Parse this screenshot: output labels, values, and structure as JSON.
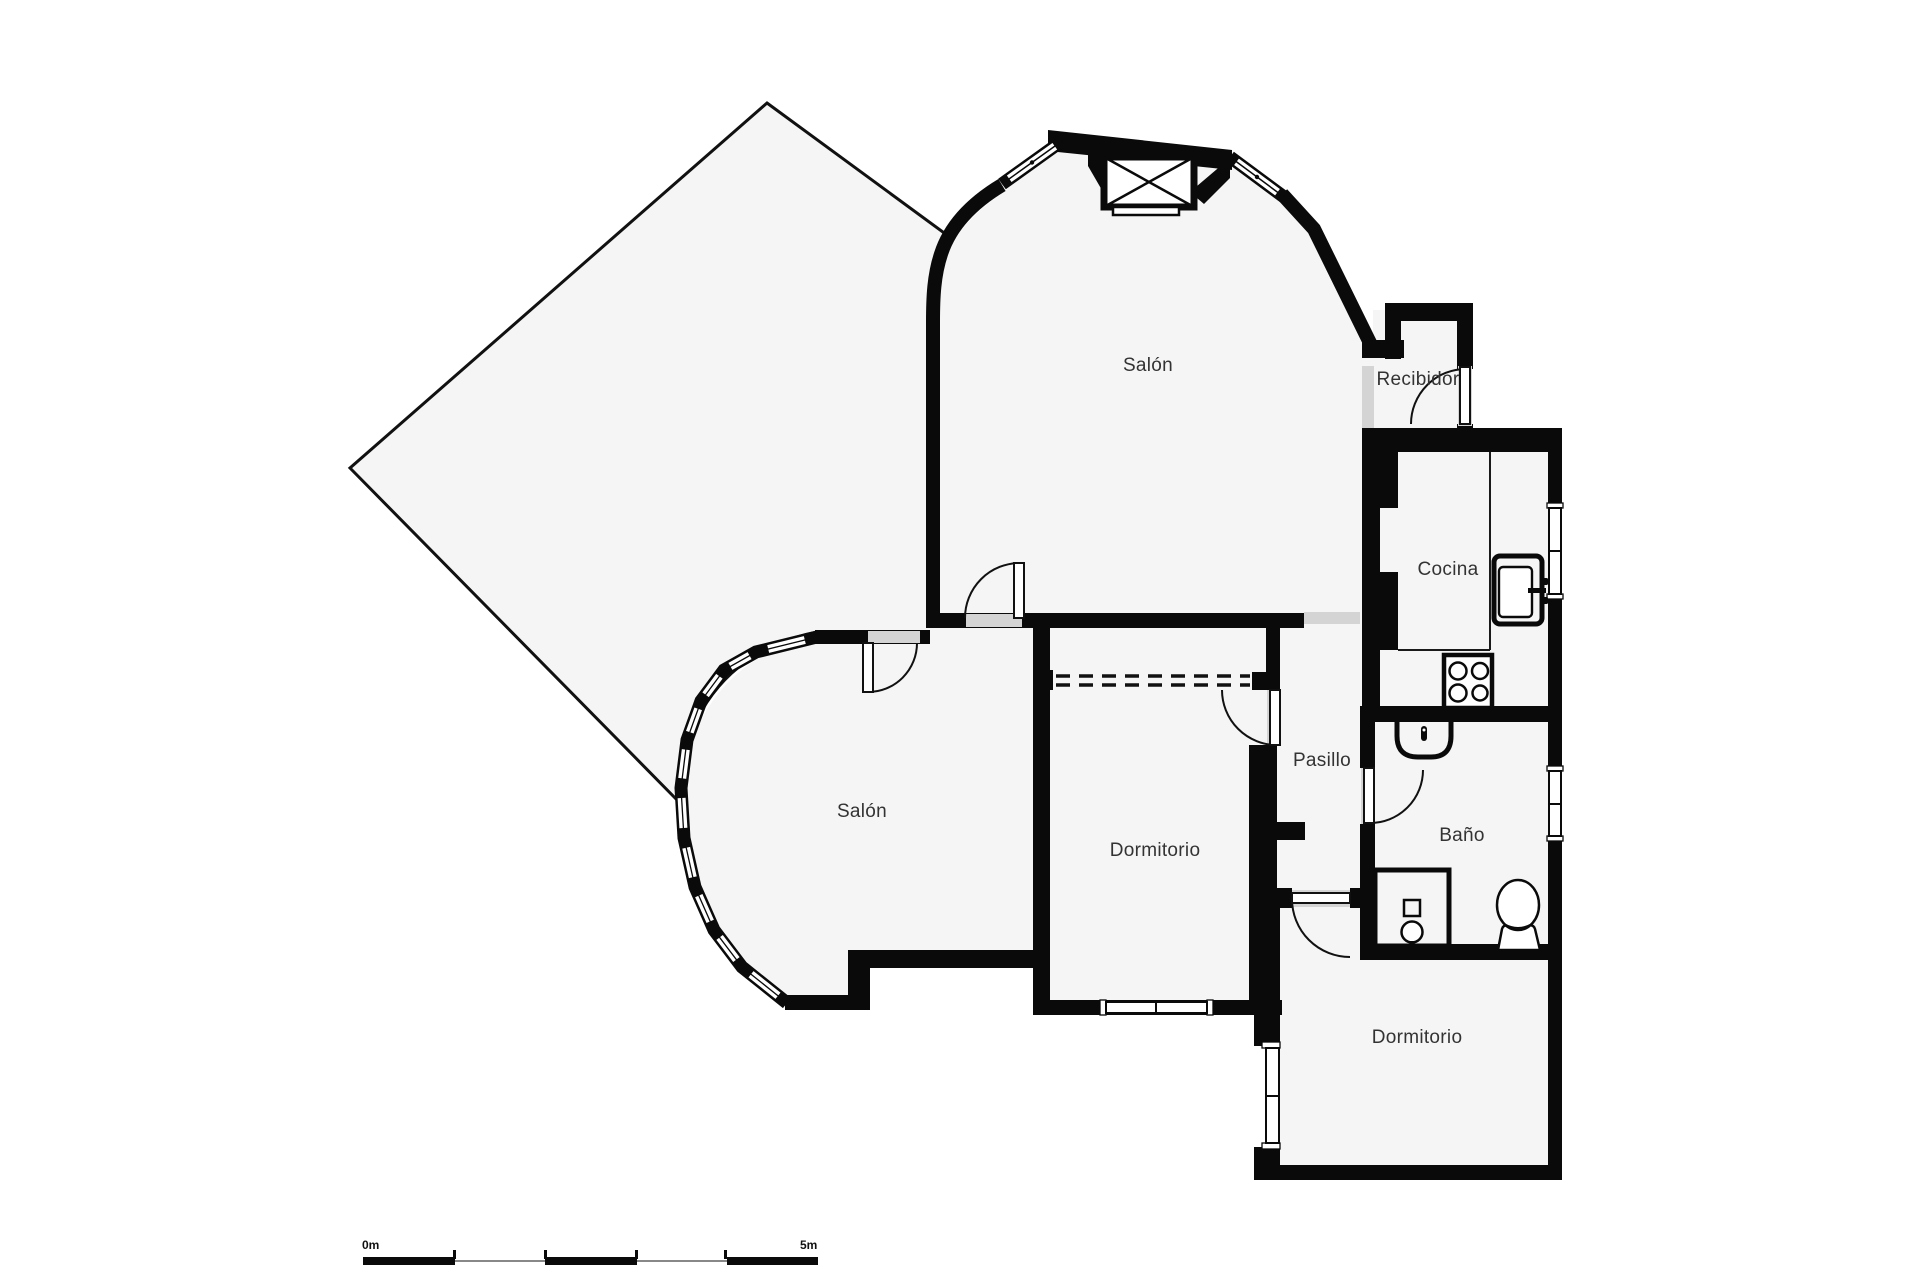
{
  "floorplan": {
    "rooms": {
      "salon_top": {
        "label": "Salón"
      },
      "salon_left": {
        "label": "Salón"
      },
      "recibidor": {
        "label": "Recibidor"
      },
      "cocina": {
        "label": "Cocina"
      },
      "pasillo": {
        "label": "Pasillo"
      },
      "bano": {
        "label": "Baño"
      },
      "dormitorio_center": {
        "label": "Dormitorio"
      },
      "dormitorio_bottom": {
        "label": "Dormitorio"
      }
    },
    "scale_bar": {
      "start_label": "0m",
      "end_label": "5m"
    },
    "colors": {
      "wall": "#0a0a0a",
      "floor": "#f5f5f5",
      "background": "#ffffff",
      "opening": "#d4d4d4",
      "text": "#333333"
    }
  }
}
